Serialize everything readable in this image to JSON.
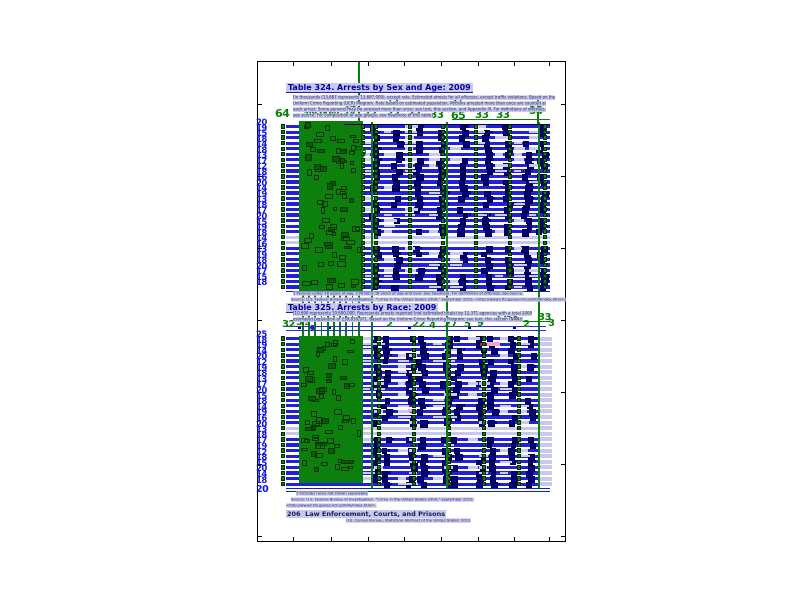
{
  "figure": {
    "type": "document-layout-visualization"
  },
  "colors": {
    "page_bg": "#ffffff",
    "frame": "#000000",
    "lavender_highlight": "#c8c8f0",
    "title_blue": "#0000a0",
    "row_blue": "#2020dd",
    "navy_box": "#000085",
    "green_fill": "#0d7f0d",
    "green_box_border": "#0a3305",
    "green_number": "#087f08",
    "blue_number": "#1212e8",
    "pink": "#f0a8c8",
    "red": "#cc2222"
  },
  "table1": {
    "title": "Table 324. Arrests by Sex and Age: 2009",
    "headnote_lines": [
      "[In thousands (13,687 represents 13,687,000), except rate. Estimated arrests for all offenses, except traffic violations. Based on the",
      "Uniform Crime Reporting (UCR) Program. Rate based on estimated population. Persons arrested more than once are counted at",
      "each arrest. Some persons may be arrested more than once; see text, this section, and Appendix III. For definitions of offenses,",
      "see source. For composition of age groups, see headnote of this table]"
    ],
    "stub_annotation": "64",
    "cluster_digits": [
      "9",
      "1",
      "8",
      "5",
      "2",
      "0",
      "7",
      "4"
    ],
    "circle_annotation": "9",
    "column_annotations": [
      "34",
      "33",
      "33",
      "33",
      "33",
      "65",
      "33",
      "33",
      "34"
    ],
    "secondary_annotations": [
      "14",
      "13",
      "17"
    ],
    "row_annotations": [
      "20",
      "19",
      "15",
      "18",
      "14",
      "18",
      "13",
      "17",
      "12",
      "18",
      "16",
      "20",
      "14",
      "19",
      "13",
      "18",
      "17",
      "20",
      "15",
      "19",
      "18",
      "14",
      "16",
      "13",
      "19",
      "18",
      "20",
      "17",
      "15",
      "18"
    ]
  },
  "between": {
    "footnote_line1": "1 Persons under 18 years of age. 2 Persons 18 years of age and over. See headnote. For definitions of offenses, see source.",
    "footnote_line2": "Source: U.S. Federal Bureau of Investigation, \"Crime in the United States 2009,\" September 2010, <http://www2.fbi.gov/ucr/cius2009/index.html>.",
    "title": "Table 325. Arrests by Race: 2009",
    "headnote_lines": [
      "[10,690 represents 10,690,000. Represents arrests reported (not estimated totals) by 12,371 agencies with a total 2009",
      "estimated population of 239,839,971. Based on the Uniform Crime Reporting Program; see text, this section  (NNN)]"
    ],
    "column_annotations": [
      "32",
      "3",
      "9",
      "2",
      "22",
      "4",
      "27",
      "5",
      "9",
      "11",
      "33",
      "2",
      "33",
      "3"
    ]
  },
  "table2": {
    "row_annotations": [
      "25",
      "18",
      "19",
      "14",
      "20",
      "12",
      "19",
      "18",
      "13",
      "17",
      "20",
      "15",
      "18",
      "14",
      "19",
      "16",
      "20",
      "13",
      "18",
      "17",
      "19",
      "12",
      "18",
      "15",
      "20",
      "14",
      "18"
    ],
    "bottom_annotation": "20"
  },
  "footer": {
    "footnote": "1 Includes races not shown separately.",
    "source_line": "Source: U.S. Federal Bureau of Investigation, \"Crime in the United States 2009,\" September 2010,",
    "url_line": "<http://www2.fbi.gov/ucr/cius2009/index.html>.",
    "page_label": "206",
    "section_label": "Law Enforcement, Courts, and Prisons",
    "credit": "U.S. Census Bureau, Statistical Abstract of the United States: 2012"
  }
}
